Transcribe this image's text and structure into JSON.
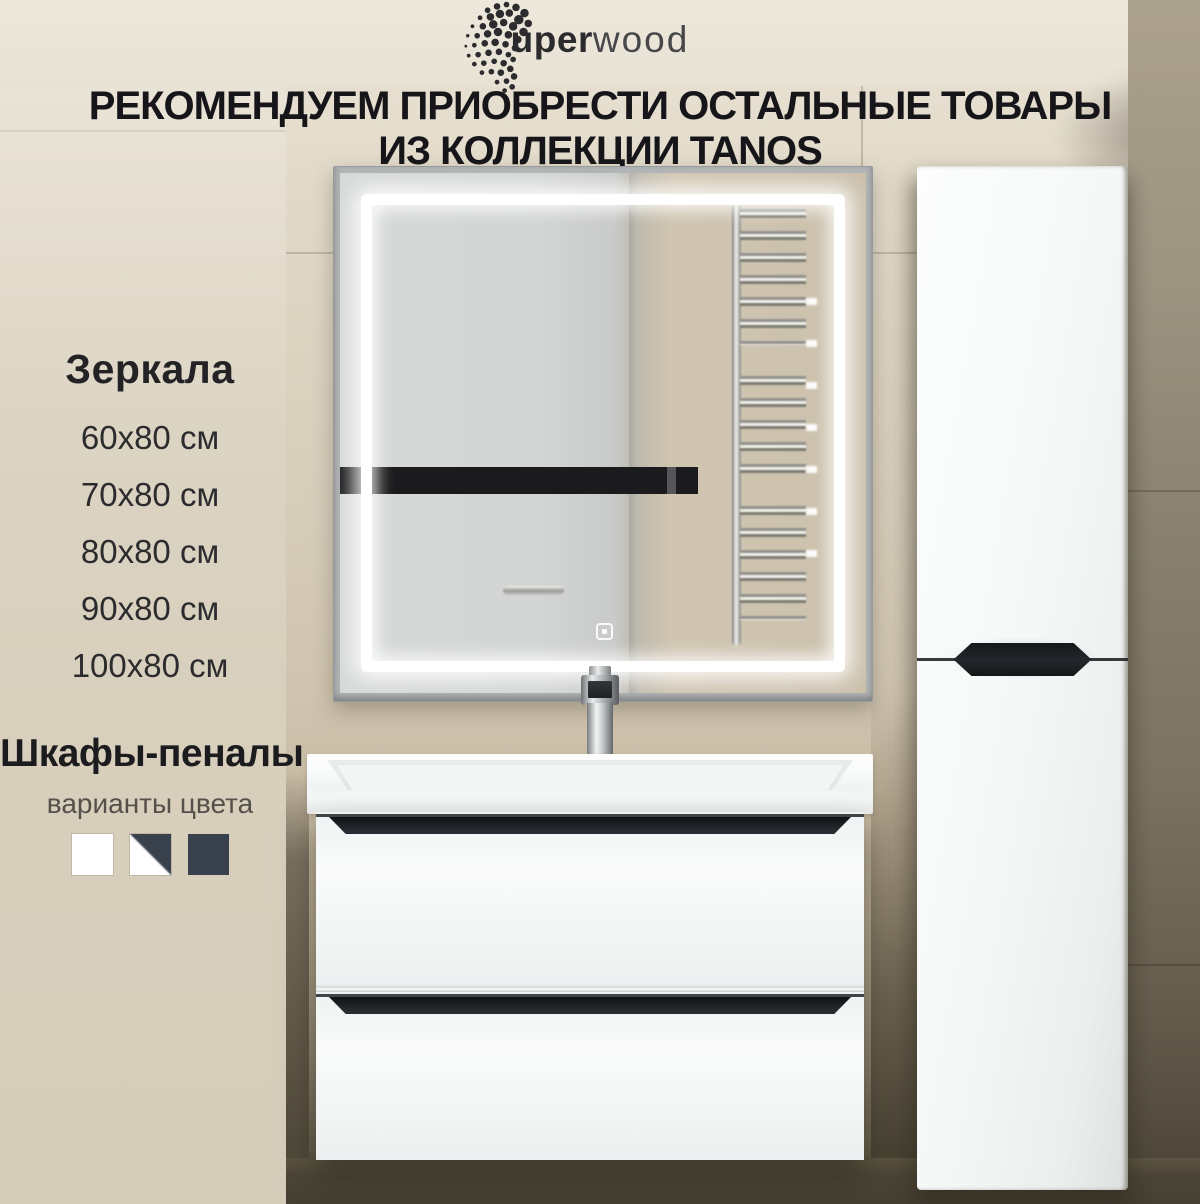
{
  "brand": {
    "logo_bold": "uper",
    "logo_light": "wood"
  },
  "heading": {
    "line1": "РЕКОМЕНДУЕМ ПРИОБРЕСТИ ОСТАЛЬНЫЕ ТОВАРЫ",
    "line2": "ИЗ КОЛЛЕКЦИИ TANOS"
  },
  "mirrors": {
    "title": "Зеркала",
    "sizes": [
      "60х80 см",
      "70х80 см",
      "80х80 см",
      "90х80 см",
      "100х80 см"
    ]
  },
  "cabinets": {
    "title": "Шкафы-пеналы",
    "subtitle": "варианты цвета",
    "color_options": [
      {
        "name": "white",
        "hex": "#ffffff"
      },
      {
        "name": "white-graphite",
        "hex_top_right": "#39424c",
        "hex_bottom_left": "#ffffff"
      },
      {
        "name": "graphite",
        "hex": "#39424c"
      }
    ]
  },
  "collection_name": "TANOS",
  "palette": {
    "text_black": "#16161a",
    "subtitle_gray": "#55504a",
    "wall_beige": "#d6ccba",
    "dark_tile_brown": "#4b4437",
    "furniture_white": "#f6f8f8",
    "handle_black": "#1d2024",
    "led_white": "#ffffff"
  },
  "icons": {
    "touch_sensor": "rounded-square-with-dot",
    "logo_dots": "halftone-dot-cluster"
  }
}
